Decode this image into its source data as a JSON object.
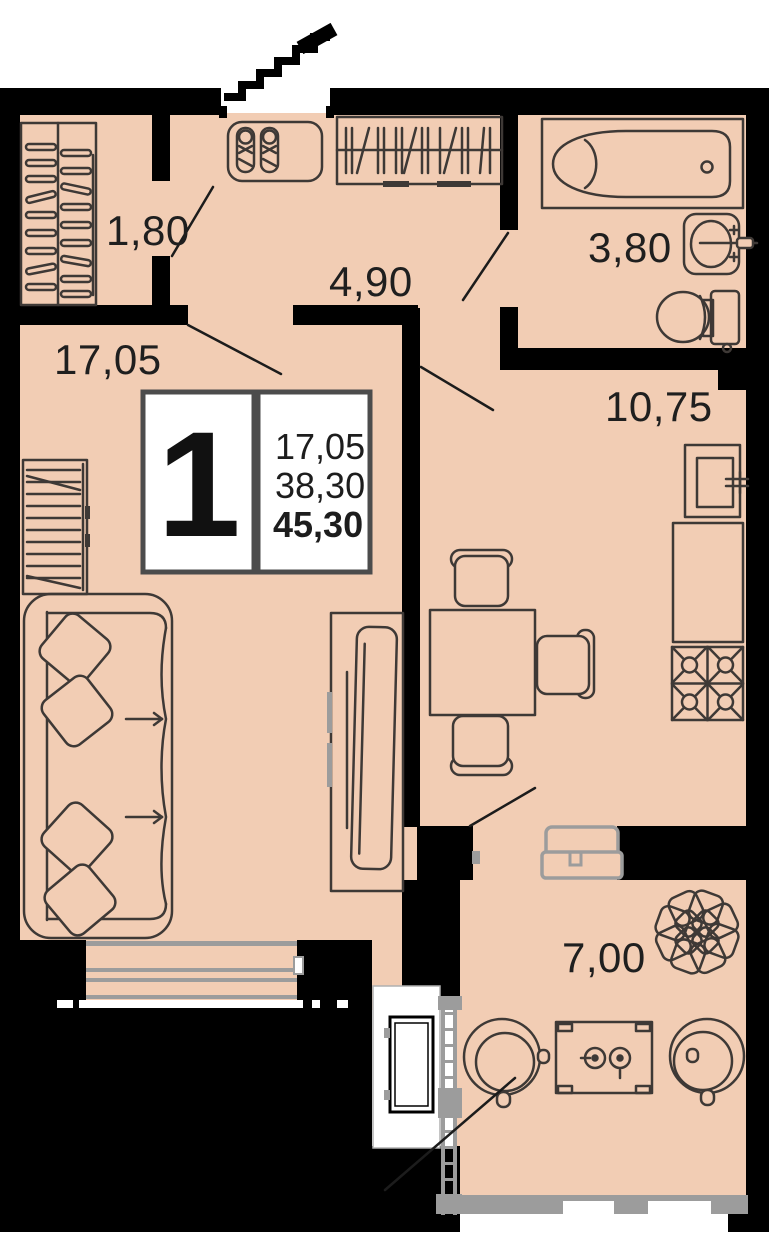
{
  "plan": {
    "info_box": {
      "unit": "1",
      "living_area": "17,05",
      "area_no_balcony": "38,30",
      "total_area": "45,30"
    },
    "rooms": [
      {
        "id": "closet",
        "label": "1,80"
      },
      {
        "id": "hallway",
        "label": "4,90"
      },
      {
        "id": "bathroom",
        "label": "3,80"
      },
      {
        "id": "living-room",
        "label": "17,05"
      },
      {
        "id": "kitchen",
        "label": "10,75"
      },
      {
        "id": "balcony",
        "label": "7,00"
      }
    ],
    "icons": [
      "entrance-stairs-icon",
      "wardrobe-icon",
      "coat-rack-icon",
      "shoe-bench-icon",
      "bathtub-icon",
      "washbasin-icon",
      "toilet-icon",
      "sofa-icon",
      "pillow-icon",
      "shelf-unit-icon",
      "tv-icon",
      "dining-table-icon",
      "chair-icon",
      "kitchen-sink-icon",
      "counter-icon",
      "stove-icon",
      "window-icon",
      "balcony-glazing-icon",
      "ac-unit-icon",
      "plant-icon",
      "round-chair-icon",
      "balcony-table-icon",
      "washing-machine-icon"
    ],
    "colors": {
      "floor": "#f2cdb4",
      "wall": "#000000",
      "outline": "#3e3936",
      "glazing": "#9c9c9c",
      "label": "#1f1f1f",
      "info_border": "#4c4c4c"
    }
  }
}
